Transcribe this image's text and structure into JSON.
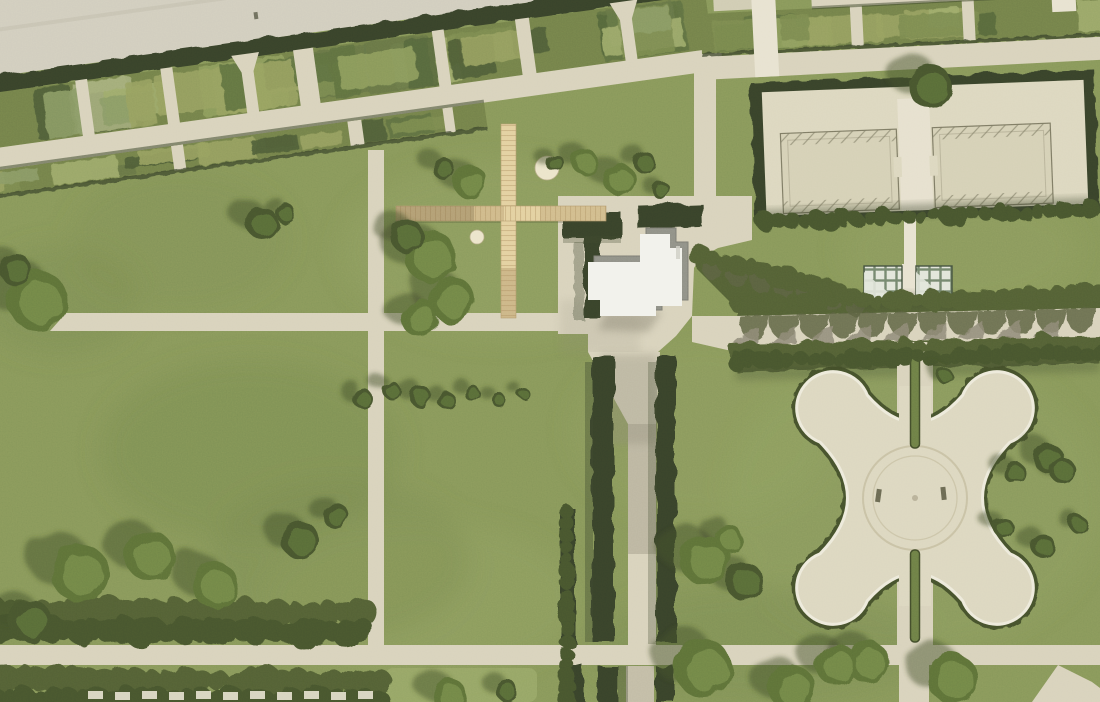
{
  "meta": {
    "type": "aerial-site-plan",
    "setting": "formal palace park with landscape-architecture intervention",
    "view": "orthographic top-down collage on orthophoto"
  },
  "features": {
    "top_left": "multi-lane road with dark boundary hedge",
    "top_strip": "diagonal allotment-garden strip with perpendicular path grid and funnel-shaped entries",
    "center_left": "open mowed lawns with scattered solitary trees",
    "installation": "cross-shaped timber boardwalk with one large and one small circular platform",
    "center": "white stepped pavilion on paved forecourt framed by clipped hedges",
    "center_south": "hedge-lined straight alley leading to the south edge",
    "east": "east-west double tree allee with scalloped tree shadows and glass canopy pavilion",
    "north_east": "rectangular hedge enclosure containing two sand courts and one round tree",
    "south_east": "baroque quatrefoil fountain plaza with double ring basin and split path with green median",
    "south_west": "dense shrub belt cut by a sand path, row of small garden sheds at the bottom edge",
    "paths": "orthogonal light sand path grid crossing the lawns"
  },
  "palette": {
    "grass_base": "#87975a",
    "grass_light": "#97a667",
    "grass_dark": "#73854b",
    "shade": "#3f4830",
    "tree_shadow": "#434d2e",
    "sand": "#d8d2bc",
    "sand_bright": "#e7e2d0",
    "sand_shadow": "#c2bca6",
    "gray_shadow": "#8e8977",
    "road": "#d1cdbe",
    "road_stripe": "#c3bfaf",
    "road_dash": "#e6e3d4",
    "hedge_dark": "#39432a",
    "hedge_mid": "#526034",
    "hedge_ring": "#424d2b",
    "bed_base": "#73814a",
    "bed_colors": [
      "#8d9c5d",
      "#667547",
      "#55663c",
      "#9dab6b",
      "#7a8a50",
      "#4d5c36",
      "#a3ad7a",
      "#5e7040",
      "#8a9a66",
      "#96a060"
    ],
    "canopy_dark": "#46542e",
    "canopy_mid": "#5d7139",
    "canopy_light": "#74894a",
    "scallop": "#5c6243",
    "boardwalk": "#e3d0a0",
    "boardwalk_plank": "#c2a878",
    "boardwalk_shade": "#a98e62",
    "boardwalk_dark": "#8b7450",
    "circle_cream": "#ebe4ca",
    "building_white": "#f2f2ec",
    "building_edge": "#8f9087",
    "court_fill": "#d5d0b6",
    "court_line": "#7d7a64",
    "court_inner": "#b8b39a",
    "court_sand": "#dcd7bf",
    "glass_green": "#74866e",
    "glass_light": "#e2e5da",
    "glass_frame": "#43503e",
    "quatrefoil_fill": "#dcd7c0",
    "quatrefoil_rim": "#edeadb",
    "quatrefoil_ring": "#c3bc9e",
    "median_green": "#6d7f46"
  },
  "bed_strips": [
    {
      "group": "beds-left-a",
      "x": -70,
      "y": 1,
      "w": 770,
      "h": 53,
      "n": 34,
      "seed": 3
    },
    {
      "group": "beds-left-b",
      "x": -45,
      "y": 78,
      "w": 515,
      "h": 23,
      "n": 14,
      "seed": 7
    },
    {
      "group": "beds-right",
      "x": 2,
      "y": 4,
      "w": 405,
      "h": 34,
      "n": 13,
      "seed": 11
    }
  ],
  "shrub_rows": [
    {
      "name": "bottomleft-upper",
      "x0": -10,
      "y0": 612,
      "x1": 362,
      "y1": 612,
      "r": 13,
      "step": 17,
      "color": "hedge_mid"
    },
    {
      "name": "bottomleft-dark",
      "x0": -10,
      "y0": 630,
      "x1": 362,
      "y1": 632,
      "r": 12,
      "step": 15,
      "color": "canopy_dark"
    },
    {
      "name": "bottomleft-lower",
      "x0": -10,
      "y0": 680,
      "x1": 380,
      "y1": 682,
      "r": 13,
      "step": 16,
      "color": "hedge_mid"
    },
    {
      "name": "bottomleft-lower2",
      "x0": -6,
      "y0": 698,
      "x1": 380,
      "y1": 699,
      "r": 10,
      "step": 15,
      "color": "canopy_dark"
    },
    {
      "name": "allee-north",
      "x0": 736,
      "y0": 303,
      "x1": 1100,
      "y1": 295,
      "r": 9,
      "step": 14,
      "color": "hedge_mid"
    },
    {
      "name": "allee-south",
      "x0": 736,
      "y0": 352,
      "x1": 1100,
      "y1": 344,
      "r": 9,
      "step": 14,
      "color": "hedge_mid"
    },
    {
      "name": "allee-south-dark",
      "x0": 736,
      "y0": 361,
      "x1": 1100,
      "y1": 353,
      "r": 8,
      "step": 13,
      "color": "canopy_dark"
    },
    {
      "name": "plaza-diagonal",
      "x0": 700,
      "y0": 256,
      "x1": 864,
      "y1": 298,
      "r": 9,
      "step": 13,
      "color": "hedge_mid"
    },
    {
      "name": "courts-south",
      "x0": 765,
      "y0": 222,
      "x1": 1090,
      "y1": 210,
      "r": 8,
      "step": 13,
      "color": "canopy_dark"
    },
    {
      "name": "alley-west-hedge",
      "x0": 566,
      "y0": 512,
      "x1": 567,
      "y1": 700,
      "r": 8,
      "step": 12,
      "color": "canopy_dark"
    }
  ],
  "scallop_rows": [
    {
      "name": "allee-canopy-shadows",
      "x0": 740,
      "y0": 316,
      "x1": 1096,
      "y1": 308,
      "n": 12,
      "size": 24,
      "type": "dome",
      "color": "scallop"
    },
    {
      "name": "allee-trunk-shadows",
      "x0": 758,
      "y0": 344,
      "x1": 1096,
      "y1": 336,
      "n": 9,
      "size": 17,
      "type": "fin",
      "color": "gray_shadow"
    },
    {
      "name": "diagonal-canopy-shadows",
      "x0": 702,
      "y0": 258,
      "x1": 868,
      "y1": 300,
      "n": 7,
      "size": 23,
      "type": "dome",
      "color": "scallop"
    }
  ],
  "sheds": {
    "x0": 88,
    "y": 691,
    "n": 11,
    "step": 27,
    "w": 15,
    "h": 8,
    "color": "sand_bright"
  },
  "trees": [
    [
      262,
      223,
      16,
      "d"
    ],
    [
      286,
      214,
      10,
      "d"
    ],
    [
      37,
      300,
      30,
      "l"
    ],
    [
      16,
      270,
      16,
      "d"
    ],
    [
      430,
      256,
      26,
      "l"
    ],
    [
      407,
      236,
      17,
      "d"
    ],
    [
      452,
      300,
      23,
      "l"
    ],
    [
      420,
      318,
      19,
      "l"
    ],
    [
      470,
      182,
      17,
      "l"
    ],
    [
      444,
      169,
      11,
      "d"
    ],
    [
      556,
      164,
      9,
      "d"
    ],
    [
      585,
      162,
      13,
      "l"
    ],
    [
      620,
      180,
      16,
      "l"
    ],
    [
      644,
      162,
      11,
      "d"
    ],
    [
      661,
      190,
      9,
      "d"
    ],
    [
      363,
      399,
      10,
      "d"
    ],
    [
      392,
      391,
      9,
      "d"
    ],
    [
      420,
      396,
      11,
      "d"
    ],
    [
      447,
      401,
      9,
      "d"
    ],
    [
      472,
      393,
      8,
      "d"
    ],
    [
      498,
      399,
      7,
      "d"
    ],
    [
      522,
      392,
      6,
      "d"
    ],
    [
      80,
      573,
      29,
      "l"
    ],
    [
      150,
      556,
      25,
      "l"
    ],
    [
      215,
      585,
      23,
      "l"
    ],
    [
      300,
      540,
      19,
      "d"
    ],
    [
      335,
      515,
      13,
      "d"
    ],
    [
      30,
      620,
      21,
      "d"
    ],
    [
      705,
      560,
      25,
      "l"
    ],
    [
      745,
      582,
      19,
      "d"
    ],
    [
      728,
      538,
      14,
      "l"
    ],
    [
      703,
      668,
      29,
      "l"
    ],
    [
      792,
      688,
      23,
      "l"
    ],
    [
      868,
      662,
      21,
      "l"
    ],
    [
      952,
      678,
      25,
      "l"
    ],
    [
      836,
      664,
      21,
      "l"
    ],
    [
      450,
      696,
      17,
      "l"
    ],
    [
      507,
      691,
      11,
      "d"
    ],
    [
      1048,
      458,
      15,
      "d"
    ],
    [
      1014,
      472,
      11,
      "d"
    ],
    [
      1062,
      470,
      13,
      "d"
    ],
    [
      1004,
      528,
      10,
      "d"
    ],
    [
      1043,
      546,
      12,
      "d"
    ],
    [
      1078,
      524,
      9,
      "d"
    ],
    [
      945,
      376,
      8,
      "d"
    ],
    [
      930,
      86,
      22,
      "d"
    ]
  ]
}
